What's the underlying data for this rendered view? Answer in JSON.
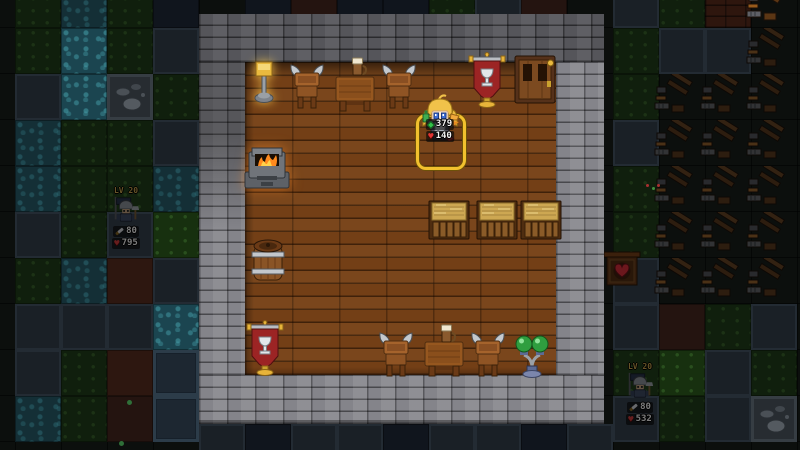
{
  "game": {
    "title": "tavern interior scene",
    "character": {
      "selected": true,
      "stats": [
        {
          "icon": "gem-green-icon",
          "value": "379"
        },
        {
          "icon": "heart-red-icon",
          "value": "140"
        }
      ]
    },
    "enemies": [
      {
        "level_label": "LV 20",
        "attack": "80",
        "health": "795"
      },
      {
        "level_label": "LV 20",
        "attack": "80",
        "health": "532"
      }
    ]
  },
  "colors": {
    "selection_gold": "#f2c12e",
    "stat_gem_green": "#35c24a",
    "stat_heart_red": "#e23535",
    "level_gold": "#d2a73e",
    "banner_red": "#9c2424",
    "fire_orange": "#ff8a1e",
    "hay_tan": "#cda752",
    "floor_wood": "#733f16",
    "wall_dark_grey": "#55555a",
    "wall_light_grey": "#84848a",
    "water_teal": "#1b4550"
  },
  "room": {
    "floor": {
      "x": 245,
      "y": 62,
      "w": 311,
      "h": 313
    }
  },
  "furniture": [
    {
      "type": "lamp-gold",
      "x": 252,
      "y": 58,
      "w": 24,
      "h": 46
    },
    {
      "type": "viking-chair",
      "x": 287,
      "y": 62,
      "w": 40,
      "h": 50
    },
    {
      "type": "table",
      "x": 333,
      "y": 68,
      "w": 44,
      "h": 46
    },
    {
      "type": "mug",
      "x": 352,
      "y": 56,
      "w": 14,
      "h": 20
    },
    {
      "type": "viking-chair",
      "x": 379,
      "y": 62,
      "w": 40,
      "h": 50
    },
    {
      "type": "banner",
      "x": 468,
      "y": 52,
      "w": 38,
      "h": 58
    },
    {
      "type": "door",
      "x": 514,
      "y": 55,
      "w": 42,
      "h": 50
    },
    {
      "type": "fireplace",
      "x": 242,
      "y": 146,
      "w": 50,
      "h": 46
    },
    {
      "type": "barrel",
      "x": 249,
      "y": 236,
      "w": 38,
      "h": 50
    },
    {
      "type": "banner",
      "x": 246,
      "y": 320,
      "w": 38,
      "h": 58
    },
    {
      "type": "hay-bed",
      "x": 428,
      "y": 199,
      "w": 42,
      "h": 42
    },
    {
      "type": "hay-bed",
      "x": 476,
      "y": 199,
      "w": 42,
      "h": 42
    },
    {
      "type": "hay-bed",
      "x": 520,
      "y": 199,
      "w": 42,
      "h": 42
    },
    {
      "type": "viking-chair",
      "x": 376,
      "y": 330,
      "w": 40,
      "h": 50
    },
    {
      "type": "table",
      "x": 422,
      "y": 334,
      "w": 44,
      "h": 44
    },
    {
      "type": "mug",
      "x": 441,
      "y": 323,
      "w": 14,
      "h": 20
    },
    {
      "type": "viking-chair",
      "x": 468,
      "y": 330,
      "w": 40,
      "h": 50
    },
    {
      "type": "green-lamp",
      "x": 514,
      "y": 328,
      "w": 36,
      "h": 50
    }
  ],
  "map": {
    "tile_size": 46,
    "tiles": [
      {
        "x": 15,
        "y": -18,
        "t": "grass"
      },
      {
        "x": 61,
        "y": -18,
        "t": "water"
      },
      {
        "x": 107,
        "y": -18,
        "t": "grass"
      },
      {
        "x": 153,
        "y": -18,
        "t": "navy"
      },
      {
        "x": 245,
        "y": -18,
        "t": "navy"
      },
      {
        "x": 291,
        "y": -18,
        "t": "dirt"
      },
      {
        "x": 337,
        "y": -18,
        "t": "navy"
      },
      {
        "x": 383,
        "y": -18,
        "t": "navy"
      },
      {
        "x": 429,
        "y": -18,
        "t": "grass"
      },
      {
        "x": 475,
        "y": -18,
        "t": "stone"
      },
      {
        "x": 521,
        "y": -18,
        "t": "dirt"
      },
      {
        "x": 613,
        "y": -18,
        "t": "stone"
      },
      {
        "x": 659,
        "y": -18,
        "t": "grass"
      },
      {
        "x": 705,
        "y": -18,
        "t": "brick"
      },
      {
        "x": 15,
        "y": 28,
        "t": "grass"
      },
      {
        "x": 61,
        "y": 28,
        "t": "water2"
      },
      {
        "x": 107,
        "y": 28,
        "t": "grass"
      },
      {
        "x": 153,
        "y": 28,
        "t": "stone"
      },
      {
        "x": 613,
        "y": 28,
        "t": "grass"
      },
      {
        "x": 659,
        "y": 28,
        "t": "stone"
      },
      {
        "x": 705,
        "y": 28,
        "t": "stone"
      },
      {
        "x": 15,
        "y": 74,
        "t": "stone"
      },
      {
        "x": 61,
        "y": 74,
        "t": "water2"
      },
      {
        "x": 107,
        "y": 74,
        "t": "rock"
      },
      {
        "x": 153,
        "y": 74,
        "t": "grass"
      },
      {
        "x": 613,
        "y": 74,
        "t": "grass"
      },
      {
        "x": 15,
        "y": 120,
        "t": "water"
      },
      {
        "x": 61,
        "y": 120,
        "t": "grass"
      },
      {
        "x": 107,
        "y": 120,
        "t": "grass"
      },
      {
        "x": 153,
        "y": 120,
        "t": "stone"
      },
      {
        "x": 613,
        "y": 120,
        "t": "stone"
      },
      {
        "x": 15,
        "y": 166,
        "t": "water"
      },
      {
        "x": 61,
        "y": 166,
        "t": "grass"
      },
      {
        "x": 107,
        "y": 166,
        "t": "grass"
      },
      {
        "x": 153,
        "y": 166,
        "t": "water"
      },
      {
        "x": 613,
        "y": 166,
        "t": "grass"
      },
      {
        "x": 15,
        "y": 212,
        "t": "stone"
      },
      {
        "x": 61,
        "y": 212,
        "t": "grass"
      },
      {
        "x": 107,
        "y": 212,
        "t": "stone"
      },
      {
        "x": 153,
        "y": 212,
        "t": "grass2"
      },
      {
        "x": 613,
        "y": 212,
        "t": "grass"
      },
      {
        "x": 15,
        "y": 258,
        "t": "grass"
      },
      {
        "x": 61,
        "y": 258,
        "t": "water"
      },
      {
        "x": 107,
        "y": 258,
        "t": "dirt2"
      },
      {
        "x": 153,
        "y": 258,
        "t": "stone"
      },
      {
        "x": 613,
        "y": 258,
        "t": "stone"
      },
      {
        "x": 15,
        "y": 304,
        "t": "stone"
      },
      {
        "x": 61,
        "y": 304,
        "t": "stone"
      },
      {
        "x": 107,
        "y": 304,
        "t": "stone"
      },
      {
        "x": 153,
        "y": 304,
        "t": "water2"
      },
      {
        "x": 613,
        "y": 304,
        "t": "stone"
      },
      {
        "x": 659,
        "y": 304,
        "t": "dirt"
      },
      {
        "x": 705,
        "y": 304,
        "t": "grass"
      },
      {
        "x": 751,
        "y": 304,
        "t": "stone"
      },
      {
        "x": 15,
        "y": 350,
        "t": "stone"
      },
      {
        "x": 61,
        "y": 350,
        "t": "grass"
      },
      {
        "x": 107,
        "y": 350,
        "t": "dirt2"
      },
      {
        "x": 153,
        "y": 350,
        "t": "slab"
      },
      {
        "x": 613,
        "y": 350,
        "t": "grass"
      },
      {
        "x": 659,
        "y": 350,
        "t": "grass2"
      },
      {
        "x": 705,
        "y": 350,
        "t": "stone"
      },
      {
        "x": 751,
        "y": 350,
        "t": "grass"
      },
      {
        "x": 15,
        "y": 396,
        "t": "water"
      },
      {
        "x": 61,
        "y": 396,
        "t": "grass"
      },
      {
        "x": 107,
        "y": 396,
        "t": "dirt"
      },
      {
        "x": 153,
        "y": 396,
        "t": "slab"
      },
      {
        "x": 613,
        "y": 396,
        "t": "stone"
      },
      {
        "x": 659,
        "y": 396,
        "t": "grass"
      },
      {
        "x": 705,
        "y": 396,
        "t": "stone"
      },
      {
        "x": 751,
        "y": 396,
        "t": "rock"
      },
      {
        "x": 199,
        "y": 424,
        "t": "stone"
      },
      {
        "x": 245,
        "y": 424,
        "t": "navy"
      },
      {
        "x": 291,
        "y": 424,
        "t": "stone"
      },
      {
        "x": 337,
        "y": 424,
        "t": "stone"
      },
      {
        "x": 383,
        "y": 424,
        "t": "navy"
      },
      {
        "x": 429,
        "y": 424,
        "t": "stone"
      },
      {
        "x": 475,
        "y": 424,
        "t": "stone"
      },
      {
        "x": 521,
        "y": 424,
        "t": "navy"
      },
      {
        "x": 567,
        "y": 424,
        "t": "stone"
      }
    ],
    "stockpiles": [
      {
        "x": 743,
        "y": -18,
        "lit": true
      },
      {
        "x": 743,
        "y": 28,
        "lit": false
      },
      {
        "x": 651,
        "y": 74,
        "lit": false
      },
      {
        "x": 697,
        "y": 74,
        "lit": false
      },
      {
        "x": 743,
        "y": 74,
        "lit": false
      },
      {
        "x": 651,
        "y": 120,
        "lit": false
      },
      {
        "x": 697,
        "y": 120,
        "lit": false
      },
      {
        "x": 743,
        "y": 120,
        "lit": false
      },
      {
        "x": 651,
        "y": 166,
        "lit": false
      },
      {
        "x": 697,
        "y": 166,
        "lit": false
      },
      {
        "x": 743,
        "y": 166,
        "lit": false
      },
      {
        "x": 651,
        "y": 212,
        "lit": false
      },
      {
        "x": 697,
        "y": 212,
        "lit": false
      },
      {
        "x": 743,
        "y": 212,
        "lit": false
      },
      {
        "x": 651,
        "y": 258,
        "lit": false
      },
      {
        "x": 697,
        "y": 258,
        "lit": false
      },
      {
        "x": 743,
        "y": 258,
        "lit": false
      }
    ],
    "decor": [
      {
        "x": 646,
        "y": 184,
        "c": "#a83030",
        "s": 3
      },
      {
        "x": 652,
        "y": 187,
        "c": "#3f8f3f",
        "s": 3
      },
      {
        "x": 657,
        "y": 184,
        "c": "#a83030",
        "s": 3
      },
      {
        "x": 127,
        "y": 400,
        "c": "#2f6f38",
        "s": 5
      },
      {
        "x": 119,
        "y": 441,
        "c": "#2f6f38",
        "s": 5
      }
    ]
  }
}
